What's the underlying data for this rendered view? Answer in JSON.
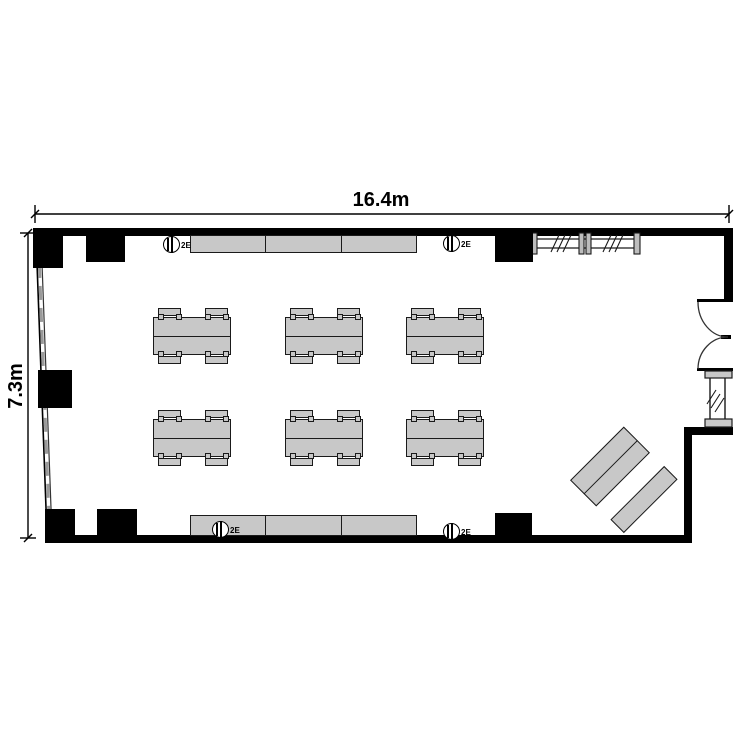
{
  "plan": {
    "type": "room-floor-plan",
    "dimensions": {
      "width_label": "16.4m",
      "height_label": "7.3m"
    },
    "outlets": {
      "label": "2E",
      "count": 4,
      "symbol": "wall-outlet-circle"
    },
    "furniture": {
      "table_groups": 6,
      "chairs_per_group": 4,
      "wall_counter_segments": 3,
      "diagonal_tables": 3
    },
    "features": [
      "double-swing-door",
      "window-wall-left",
      "window-right",
      "movable-partition-top-right"
    ],
    "colors": {
      "wall": "#000000",
      "furniture_fill": "#c8c8c8",
      "line": "#1a1a1a",
      "background": "#ffffff"
    }
  }
}
